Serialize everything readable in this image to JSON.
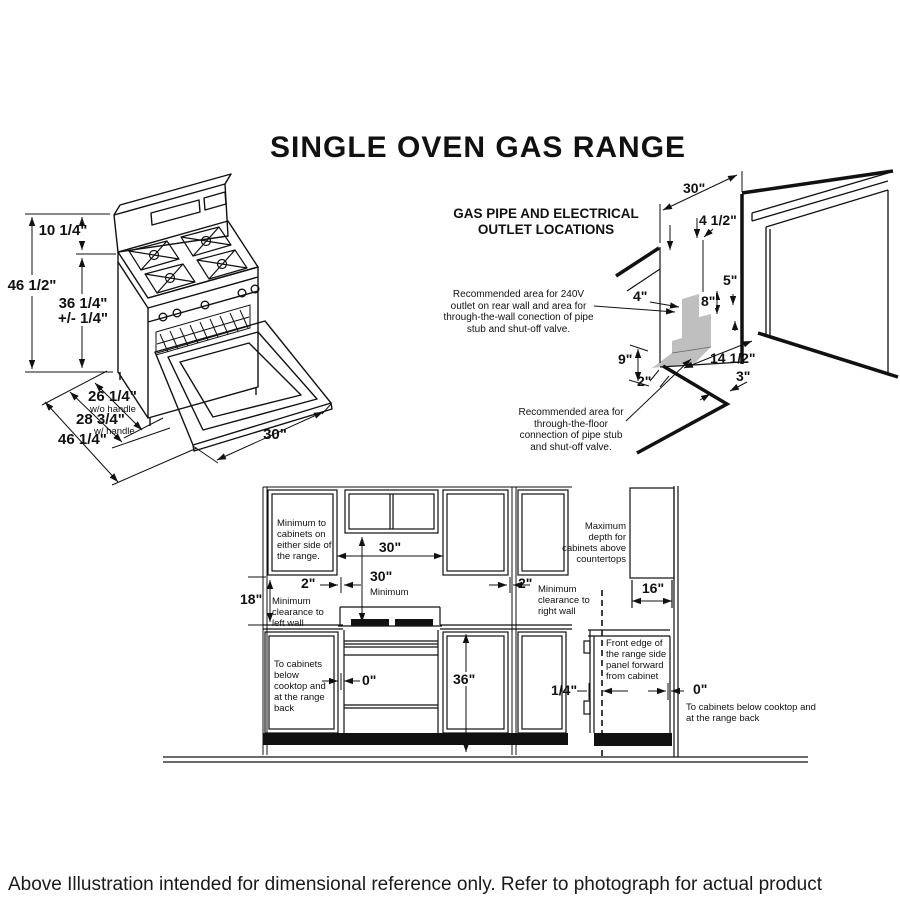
{
  "title": "SINGLE OVEN GAS RANGE",
  "footer": "Above Illustration intended for dimensional reference only. Refer to photograph for actual product appearance.",
  "colors": {
    "line": "#111111",
    "shade": "#bfbfbf",
    "background": "#ffffff"
  },
  "range_view": {
    "backsplash_height": "10 1/4\"",
    "overall_height": "46 1/2\"",
    "cooktop_height": "36 1/4\"",
    "cooktop_height_tolerance": "+/- 1/4\"",
    "depth_without_handle": "26 1/4\"",
    "depth_without_handle_note": "w/o handle",
    "depth_with_handle": "28 3/4\"",
    "depth_with_handle_note": "w/ handle",
    "depth_door_open": "46 1/4\"",
    "width": "30\""
  },
  "gas_pipe_view": {
    "heading_line1": "GAS PIPE AND ELECTRICAL",
    "heading_line2": "OUTLET LOCATIONS",
    "wall_note": "Recommended area for 240V outlet on rear wall and area for through-the-wall conection of pipe stub and shut-off valve.",
    "floor_note": "Recommended area for through-the-floor connection of pipe stub and shut-off valve.",
    "dim_30": "30\"",
    "dim_4_half": "4 1/2\"",
    "dim_5": "5\"",
    "dim_4": "4\"",
    "dim_8": "8\"",
    "dim_9": "9\"",
    "dim_2": "2\"",
    "dim_14_half": "14 1/2\"",
    "dim_3": "3\""
  },
  "clearance_view": {
    "side_cabinet_note": "Minimum to cabinets on either side of the range.",
    "dim_30_between_cabinets": "30\"",
    "dim_30_vertical": "30\"",
    "dim_30_vertical_note": "Minimum",
    "dim_2_left": "2\"",
    "left_wall_note": "Minimum clearance to left wall",
    "dim_2_right": "2\"",
    "right_wall_note": "Minimum clearance to right wall",
    "dim_18": "18\"",
    "below_cooktop_note": "To cabinets below cooktop and at the range back",
    "dim_0_left": "0\"",
    "dim_36": "36\"",
    "max_depth_note": "Maximum depth for cabinets above countertops",
    "dim_16": "16\"",
    "dim_quarter": "1/4\"",
    "front_edge_note": "Front edge of the range side panel forward from cabinet",
    "dim_0_right": "0\"",
    "below_cooktop_note_right": "To cabinets below cooktop and at the range back"
  }
}
